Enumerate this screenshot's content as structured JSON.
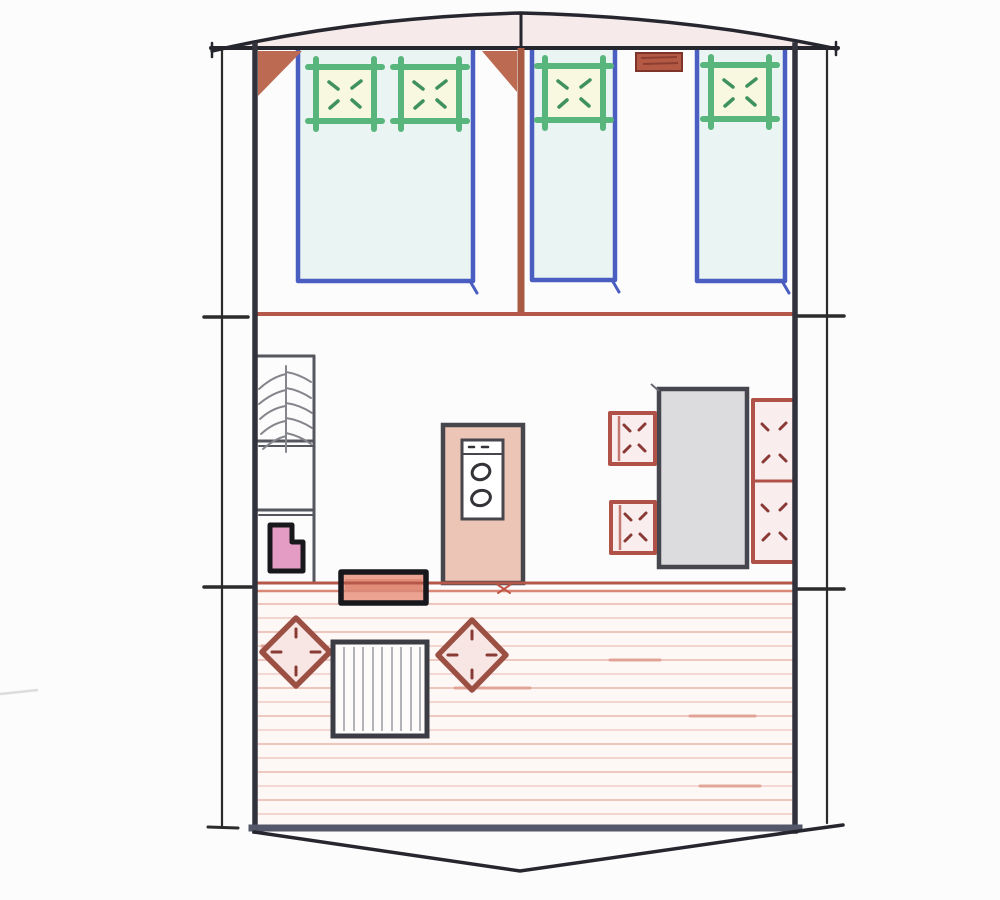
{
  "colors": {
    "paper": "#fcfcfc",
    "ink": "#26262e",
    "frame": "#32323d",
    "frame-bottom": "#535769",
    "roof-tint": "#f6ebea",
    "bed-blue": "#4a5ec2",
    "bed-fill": "#eaf4f3",
    "pillow-green": "#58b57c",
    "pillow-fill": "#f8f7e0",
    "pillow-mark": "#3f925c",
    "wood": "#a85a42",
    "wood-light": "#bc6a52",
    "divider-red": "#b5584a",
    "divider-red2": "#d98878",
    "shelf-line": "#55565e",
    "sketch-gray": "#85858c",
    "fridge-pink": "#e59cc4",
    "stove-fill": "#edc5b6",
    "table-gray": "#dcdcde",
    "chair-red": "#b05248",
    "chair-mark": "#8a3a34",
    "deck-bg": "#fdf7f6",
    "deck-line": "#ecc0b8",
    "diamond-red": "#9c5044",
    "mat-fill": "#eca492"
  },
  "floor_plan": {
    "structure": [
      "curved-roof-ridge",
      "tent-walls",
      "guy-lines-with-tick-marks",
      "entrance-curve"
    ],
    "areas": [
      {
        "name": "sleeping-area",
        "items": [
          "double-bed-with-two-pillows",
          "single-bed-center",
          "single-bed-right",
          "center-post-with-brace",
          "corner-brace",
          "overhead-shelf"
        ]
      },
      {
        "name": "living-area",
        "items": [
          "shelf-unit-with-hooks",
          "mini-fridge",
          "stove-two-burners",
          "dining-table",
          "chair-upper",
          "chair-lower",
          "wall-bench-two-seats",
          "doormat"
        ]
      },
      {
        "name": "deck",
        "items": [
          "plank-flooring",
          "deck-chair-left-diamond",
          "slatted-table",
          "deck-chair-right-diamond"
        ]
      }
    ]
  }
}
